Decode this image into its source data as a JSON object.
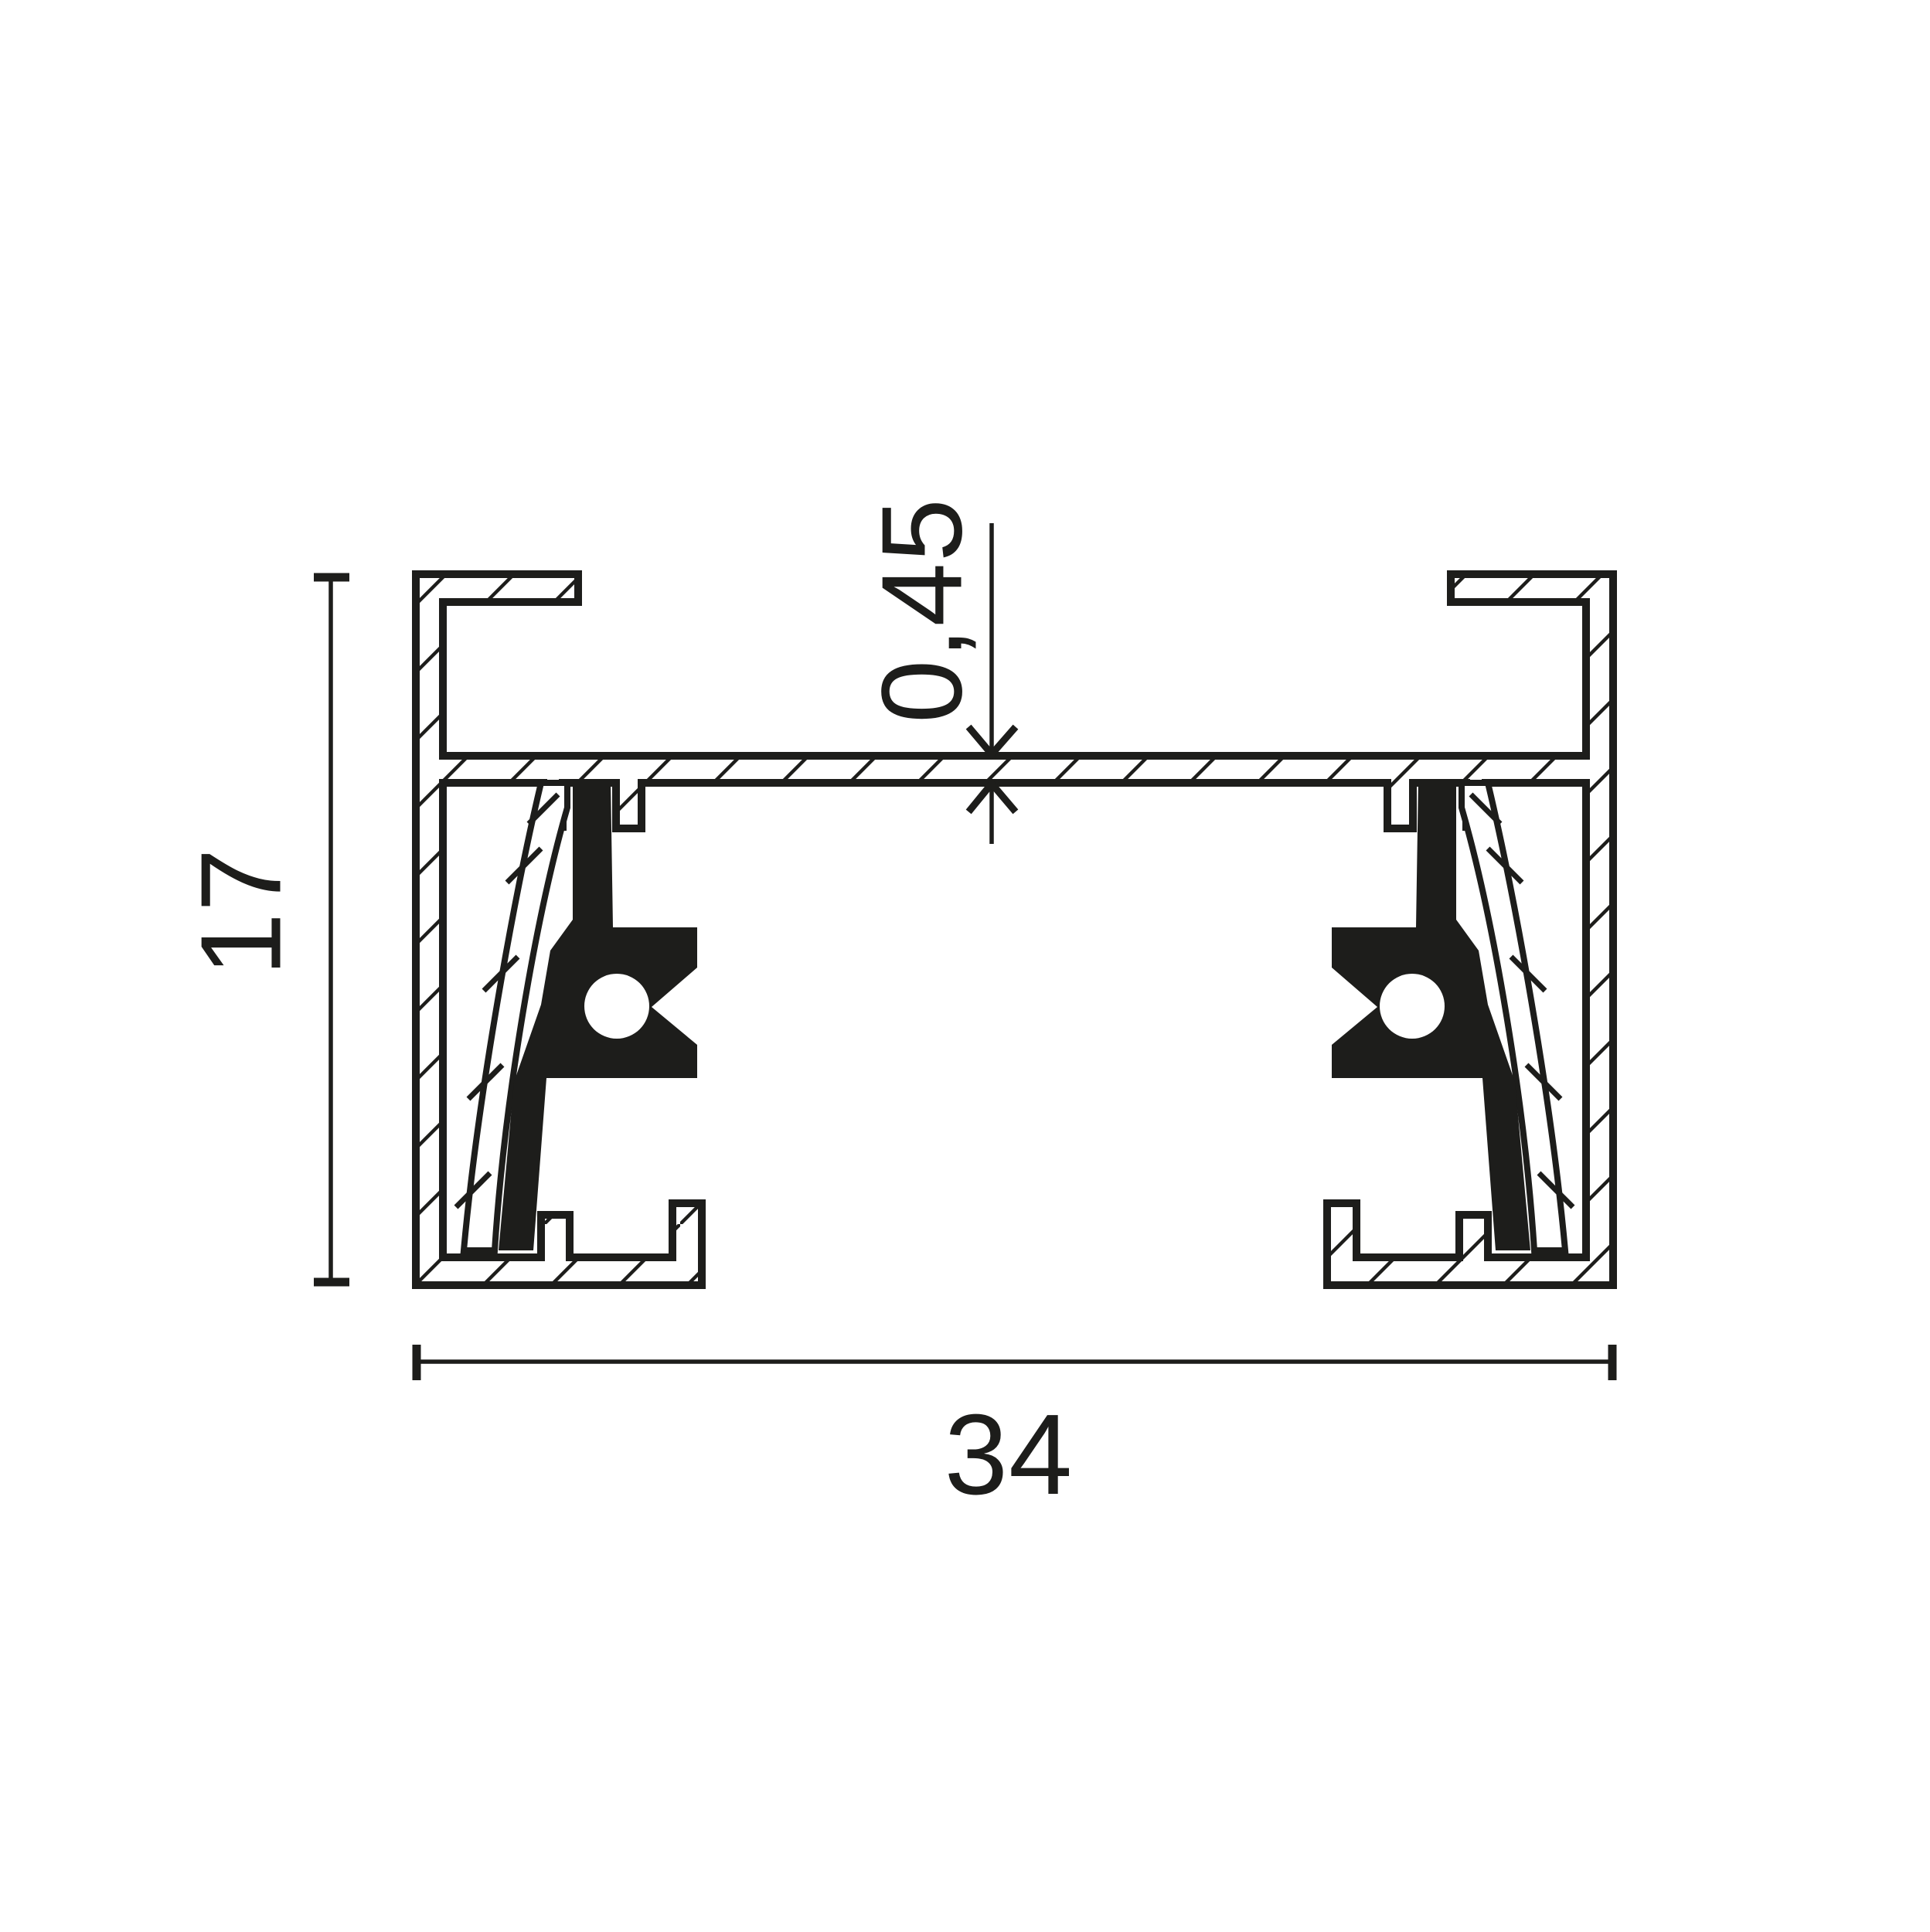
{
  "page": {
    "background": "#ffffff",
    "ink_color": "#1d1d1b"
  },
  "drawing": {
    "name": "track-rail-profile-cross-section",
    "dimensions": {
      "height_label": "17",
      "width_label": "34",
      "thickness_label": "0,45"
    }
  }
}
